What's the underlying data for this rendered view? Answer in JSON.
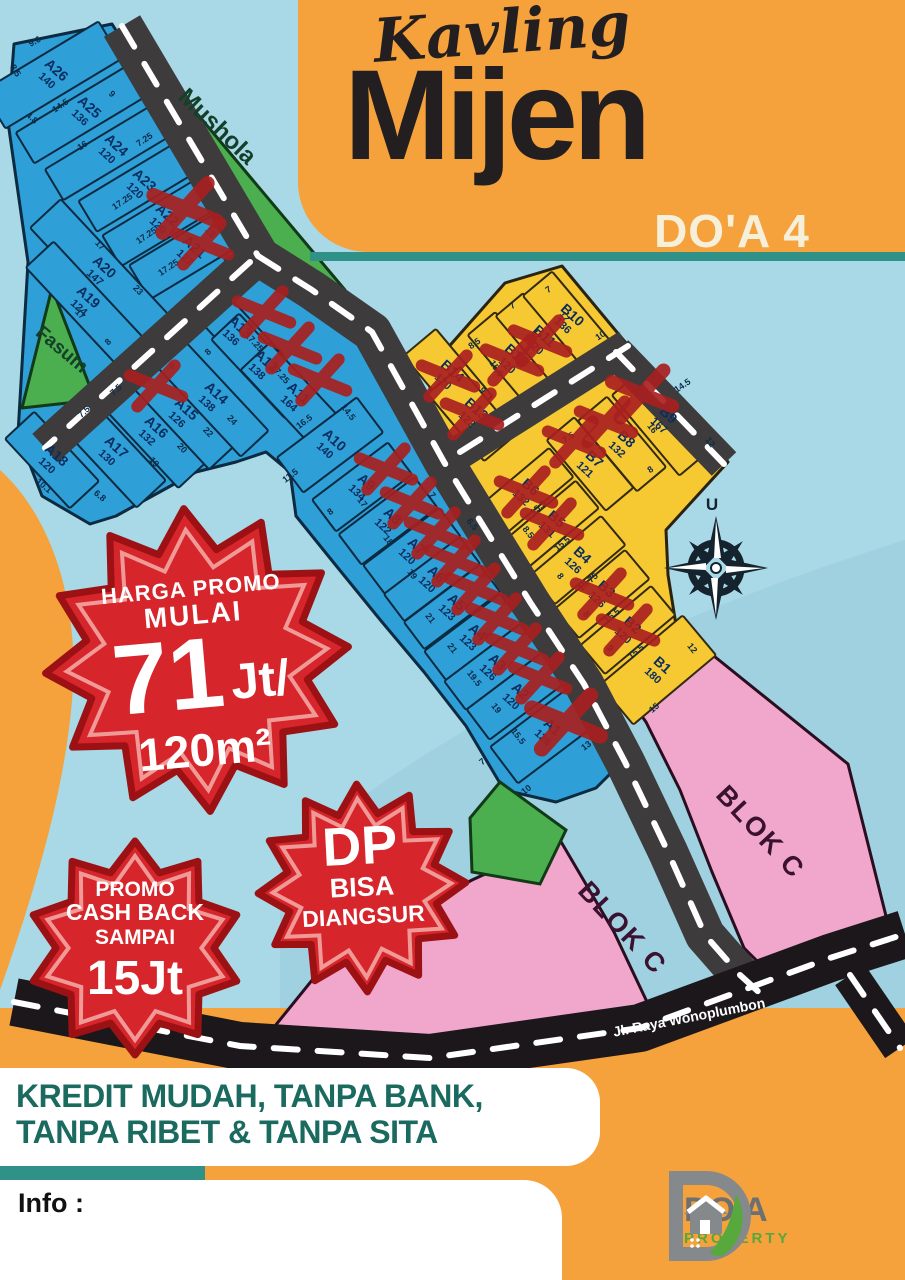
{
  "header": {
    "script_title": "Kavling",
    "main_title": "Mijen",
    "sub_title": "DO'A 4"
  },
  "map": {
    "north_indicator": "U",
    "street_label": "Jl. Raya Wonoplumbon",
    "zones": {
      "mushola": "Mushola",
      "fasum": "Fasum",
      "blok_c_upper": "BLOK C",
      "blok_c_lower": "BLOK C"
    },
    "plots": [
      {
        "id": "A26",
        "area": 140,
        "x": 52,
        "y": 75,
        "ax": -31,
        "d": 135,
        "w": 44,
        "c": "b",
        "sold": false
      },
      {
        "id": "A25",
        "area": 136,
        "x": 85,
        "y": 112,
        "ax": -31,
        "d": 140,
        "w": 36,
        "c": "b",
        "sold": false
      },
      {
        "id": "A24",
        "area": 120,
        "x": 112,
        "y": 150,
        "ax": -31,
        "d": 135,
        "w": 36,
        "c": "b",
        "sold": false
      },
      {
        "id": "A23",
        "area": 120,
        "x": 140,
        "y": 185,
        "ax": -31,
        "d": 122,
        "w": 36,
        "c": "b",
        "sold": false
      },
      {
        "id": "A22",
        "area": 120,
        "x": 163,
        "y": 220,
        "ax": -31,
        "d": 120,
        "w": 36,
        "c": "b",
        "sold": true,
        "ox": 22,
        "oy": -12,
        "xs": 1.2
      },
      {
        "id": "A21",
        "area": 127,
        "x": 190,
        "y": 252,
        "ax": -31,
        "d": 118,
        "w": 40,
        "c": "b",
        "sold": true,
        "ox": 12,
        "oy": -8
      },
      {
        "id": "A20",
        "area": 147,
        "x": 100,
        "y": 272,
        "ax": 47,
        "d": 160,
        "w": 42,
        "c": "b",
        "sold": false
      },
      {
        "id": "A19",
        "area": 124,
        "x": 84,
        "y": 302,
        "ax": 47,
        "d": 130,
        "w": 38,
        "c": "b",
        "sold": false
      },
      {
        "id": "A18",
        "area": 120,
        "x": 52,
        "y": 460,
        "ax": 47,
        "d": 95,
        "w": 40,
        "c": "b",
        "sold": false
      },
      {
        "id": "A17",
        "area": 130,
        "x": 112,
        "y": 452,
        "ax": 47,
        "d": 115,
        "w": 40,
        "c": "b",
        "sold": false
      },
      {
        "id": "A16",
        "area": 132,
        "x": 152,
        "y": 432,
        "ax": 47,
        "d": 118,
        "w": 38,
        "c": "b",
        "sold": false
      },
      {
        "id": "A15",
        "area": 126,
        "x": 182,
        "y": 414,
        "ax": 47,
        "d": 118,
        "w": 36,
        "c": "b",
        "sold": true,
        "ox": -26,
        "oy": -28
      },
      {
        "id": "A14",
        "area": 138,
        "x": 212,
        "y": 398,
        "ax": 47,
        "d": 125,
        "w": 38,
        "c": "b",
        "sold": false
      },
      {
        "id": "A13",
        "area": 136,
        "x": 236,
        "y": 332,
        "ax": 47,
        "d": 100,
        "w": 38,
        "c": "b",
        "sold": true,
        "ox": 28,
        "oy": -20
      },
      {
        "id": "A12",
        "area": 138,
        "x": 262,
        "y": 366,
        "ax": 47,
        "d": 108,
        "w": 38,
        "c": "b",
        "sold": true,
        "ox": 28,
        "oy": -18
      },
      {
        "id": "A11",
        "area": 164,
        "x": 294,
        "y": 398,
        "ax": 47,
        "d": 114,
        "w": 40,
        "c": "b",
        "sold": true,
        "ox": 26,
        "oy": -18
      },
      {
        "id": "A10",
        "area": 140,
        "x": 330,
        "y": 445,
        "ax": -37,
        "d": 100,
        "w": 44,
        "c": "b",
        "sold": false
      },
      {
        "id": "A9",
        "area": 134,
        "x": 362,
        "y": 487,
        "ax": -37,
        "d": 95,
        "w": 40,
        "c": "b",
        "sold": true,
        "ox": 24,
        "oy": -18
      },
      {
        "id": "A8",
        "area": 122,
        "x": 388,
        "y": 521,
        "ax": -37,
        "d": 95,
        "w": 38,
        "c": "b",
        "sold": true,
        "ox": 24,
        "oy": -18
      },
      {
        "id": "A7",
        "area": 120,
        "x": 412,
        "y": 551,
        "ax": -37,
        "d": 95,
        "w": 36,
        "c": "b",
        "sold": true,
        "ox": 24,
        "oy": -18
      },
      {
        "id": "A6",
        "area": 120,
        "x": 432,
        "y": 579,
        "ax": -37,
        "d": 95,
        "w": 34,
        "c": "b",
        "sold": true,
        "ox": 24,
        "oy": -18
      },
      {
        "id": "A5",
        "area": 123,
        "x": 452,
        "y": 607,
        "ax": -37,
        "d": 95,
        "w": 34,
        "c": "b",
        "sold": true,
        "ox": 24,
        "oy": -18
      },
      {
        "id": "A4",
        "area": 123,
        "x": 473,
        "y": 637,
        "ax": -37,
        "d": 95,
        "w": 36,
        "c": "b",
        "sold": true,
        "ox": 24,
        "oy": -18
      },
      {
        "id": "A3",
        "area": 126,
        "x": 493,
        "y": 667,
        "ax": -37,
        "d": 95,
        "w": 36,
        "c": "b",
        "sold": true,
        "ox": 24,
        "oy": -18
      },
      {
        "id": "A2",
        "area": 120,
        "x": 516,
        "y": 696,
        "ax": -37,
        "d": 95,
        "w": 38,
        "c": "b",
        "sold": true,
        "ox": 24,
        "oy": -18
      },
      {
        "id": "A1",
        "area": 126,
        "x": 548,
        "y": 732,
        "ax": -37,
        "d": 110,
        "w": 46,
        "c": "b",
        "sold": true,
        "ox": 18,
        "oy": -10,
        "xs": 1.3
      },
      {
        "id": "B14",
        "area": 120,
        "x": 448,
        "y": 376,
        "ax": 50,
        "d": 88,
        "w": 42,
        "c": "y",
        "sold": true
      },
      {
        "id": "B13",
        "area": 122,
        "x": 472,
        "y": 414,
        "ax": 50,
        "d": 88,
        "w": 42,
        "c": "y",
        "sold": true
      },
      {
        "id": "B12",
        "area": 120,
        "x": 512,
        "y": 360,
        "ax": 50,
        "d": 95,
        "w": 36,
        "c": "y",
        "sold": true
      },
      {
        "id": "B11",
        "area": 120,
        "x": 540,
        "y": 341,
        "ax": 50,
        "d": 95,
        "w": 36,
        "c": "y",
        "sold": true
      },
      {
        "id": "B10",
        "area": 136,
        "x": 568,
        "y": 320,
        "ax": 50,
        "d": 95,
        "w": 38,
        "c": "y",
        "sold": false
      },
      {
        "id": "B9",
        "area": 167,
        "x": 664,
        "y": 420,
        "ax": 50,
        "d": 105,
        "w": 48,
        "c": "y",
        "sold": true,
        "ox": -22,
        "oy": -26,
        "xs": 1.15
      },
      {
        "id": "B8",
        "area": 132,
        "x": 622,
        "y": 444,
        "ax": 50,
        "d": 92,
        "w": 38,
        "c": "y",
        "sold": true,
        "ox": -16,
        "oy": -22
      },
      {
        "id": "B7",
        "area": 121,
        "x": 590,
        "y": 464,
        "ax": 50,
        "d": 92,
        "w": 36,
        "c": "y",
        "sold": true,
        "ox": -16,
        "oy": -22
      },
      {
        "id": "B6",
        "area": 132,
        "x": 526,
        "y": 492,
        "ax": -40,
        "d": 92,
        "w": 38,
        "c": "y",
        "sold": true
      },
      {
        "id": "B5",
        "area": 131,
        "x": 552,
        "y": 524,
        "ax": -40,
        "d": 92,
        "w": 36,
        "c": "y",
        "sold": true
      },
      {
        "id": "B4",
        "area": 126,
        "x": 578,
        "y": 560,
        "ax": -40,
        "d": 92,
        "w": 38,
        "c": "y",
        "sold": false
      },
      {
        "id": "B3",
        "area": 126,
        "x": 602,
        "y": 594,
        "ax": -40,
        "d": 92,
        "w": 38,
        "c": "y",
        "sold": true
      },
      {
        "id": "B2",
        "area": 120,
        "x": 628,
        "y": 630,
        "ax": -40,
        "d": 92,
        "w": 38,
        "c": "y",
        "sold": true
      },
      {
        "id": "B1",
        "area": 180,
        "x": 658,
        "y": 670,
        "ax": -40,
        "d": 108,
        "w": 52,
        "c": "y",
        "sold": false
      }
    ],
    "dims": [
      [
        "9.6",
        36,
        44,
        -28
      ],
      [
        "8.5",
        13,
        72,
        58
      ],
      [
        "4.8",
        30,
        120,
        42
      ],
      [
        "14.5",
        62,
        108,
        -34
      ],
      [
        "16",
        84,
        148,
        -34
      ],
      [
        "9",
        110,
        96,
        44
      ],
      [
        "7.25",
        146,
        142,
        -34
      ],
      [
        "17.25",
        124,
        204,
        -34
      ],
      [
        "17.25",
        148,
        238,
        -34
      ],
      [
        "17.25",
        170,
        270,
        -34
      ],
      [
        "13",
        208,
        234,
        50
      ],
      [
        "9",
        224,
        260,
        50
      ],
      [
        "17",
        98,
        247,
        47
      ],
      [
        "23",
        136,
        292,
        47
      ],
      [
        "17",
        78,
        316,
        47
      ],
      [
        "8",
        110,
        344,
        -43
      ],
      [
        "6",
        174,
        368,
        -43
      ],
      [
        "8",
        210,
        354,
        -43
      ],
      [
        "17.25",
        252,
        344,
        47
      ],
      [
        "17.25",
        278,
        376,
        47
      ],
      [
        "24",
        230,
        422,
        47
      ],
      [
        "22",
        206,
        434,
        47
      ],
      [
        "20",
        180,
        450,
        47
      ],
      [
        "19",
        152,
        464,
        47
      ],
      [
        "7.5",
        118,
        392,
        -43
      ],
      [
        "7.5",
        86,
        414,
        -43
      ],
      [
        "10.1",
        42,
        488,
        40
      ],
      [
        "6.8",
        98,
        498,
        40
      ],
      [
        "16.5",
        306,
        424,
        -37
      ],
      [
        "14.5",
        346,
        414,
        52
      ],
      [
        "11.5",
        292,
        478,
        -37
      ],
      [
        "8",
        332,
        514,
        -37
      ],
      [
        "17",
        360,
        504,
        52
      ],
      [
        "18",
        386,
        542,
        52
      ],
      [
        "7",
        430,
        497,
        52
      ],
      [
        "6.5",
        470,
        526,
        52
      ],
      [
        "19",
        410,
        576,
        52
      ],
      [
        "21",
        428,
        620,
        52
      ],
      [
        "21",
        450,
        650,
        52
      ],
      [
        "19.5",
        472,
        680,
        52
      ],
      [
        "19",
        494,
        710,
        52
      ],
      [
        "15.5",
        516,
        738,
        52
      ],
      [
        "7",
        484,
        764,
        -37
      ],
      [
        "10",
        528,
        792,
        -37
      ],
      [
        "13",
        588,
        748,
        -37
      ],
      [
        "8.5",
        476,
        346,
        -34
      ],
      [
        "7",
        514,
        308,
        -34
      ],
      [
        "7",
        550,
        292,
        -34
      ],
      [
        "17",
        562,
        318,
        56
      ],
      [
        "17",
        534,
        336,
        56
      ],
      [
        "15.5",
        494,
        370,
        56
      ],
      [
        "9",
        480,
        392,
        56
      ],
      [
        "10",
        602,
        338,
        -34
      ],
      [
        "14.5",
        684,
        388,
        -34
      ],
      [
        "12",
        708,
        444,
        52
      ],
      [
        "16",
        650,
        430,
        52
      ],
      [
        "8",
        652,
        472,
        -34
      ],
      [
        "7.5",
        570,
        440,
        -34
      ],
      [
        "15.5",
        540,
        510,
        -40
      ],
      [
        "8.5",
        526,
        534,
        52
      ],
      [
        "15.5",
        564,
        546,
        -40
      ],
      [
        "8",
        558,
        578,
        52
      ],
      [
        "15.75",
        590,
        584,
        -40
      ],
      [
        "8",
        584,
        616,
        52
      ],
      [
        "15.5",
        614,
        618,
        -40
      ],
      [
        "9",
        608,
        650,
        52
      ],
      [
        "15.5",
        638,
        654,
        -40
      ],
      [
        "15",
        656,
        710,
        -40
      ],
      [
        "12",
        690,
        650,
        52
      ]
    ]
  },
  "badges": {
    "price_promo": {
      "line1": "HARGA PROMO",
      "line2": "MULAI",
      "price": "71",
      "price_unit": "Jt/",
      "per_size": "120m²"
    },
    "cashback": {
      "line1": "PROMO",
      "line2": "CASH BACK",
      "line3": "SAMPAI",
      "value": "15Jt"
    },
    "dp": {
      "line1": "DP",
      "line2": "BISA",
      "line3": "DIANGSUR"
    }
  },
  "banner": {
    "line1": "KREDIT MUDAH, TANPA BANK,",
    "line2": "TANPA RIBET & TANPA SITA"
  },
  "info_label": "Info :",
  "logo": {
    "name": "DO'A",
    "type": "PROPERTY"
  },
  "colors": {
    "orange": "#F5A13C",
    "sky": "#A9D8E6",
    "plot_blue": "#2F9FD8",
    "plot_yellow": "#F6C832",
    "zone_green": "#4BAE4F",
    "blok_pink": "#F0A7CB",
    "road": "#3D3B3C",
    "main_road": "#1B171B",
    "sold_red": "#A8201F",
    "star_red": "#D6252B",
    "teal": "#1A6A60"
  }
}
